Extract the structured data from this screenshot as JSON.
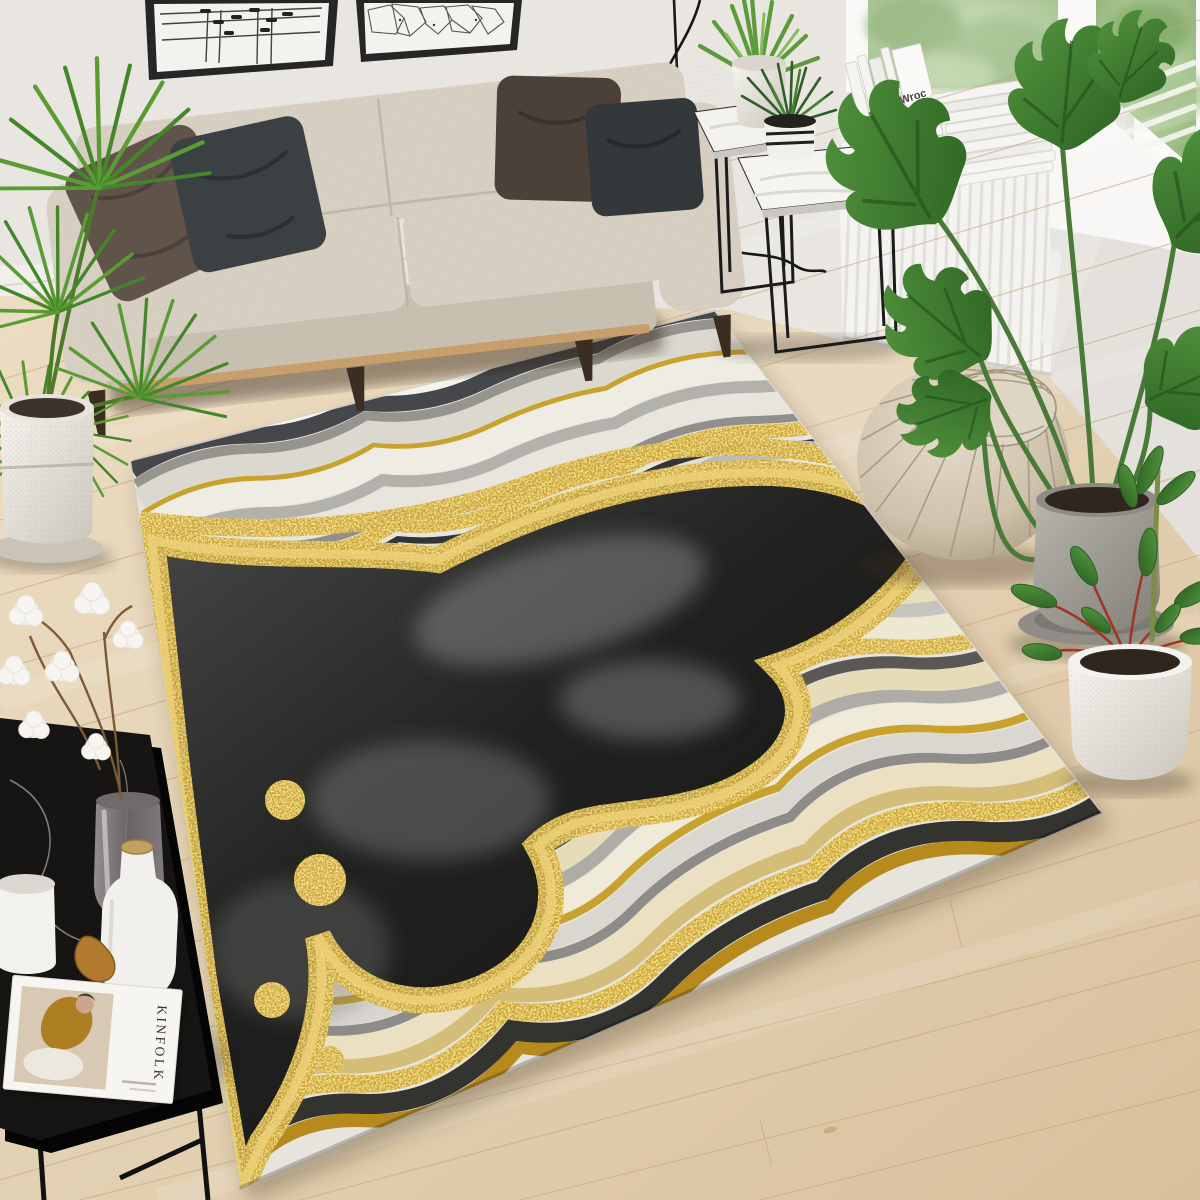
{
  "meta": {
    "scene": "living room lifestyle product photo",
    "subject": "black gold white abstract marble agate area rug",
    "view": "elevated three-quarter perspective"
  },
  "texts": {
    "magazine_title": "KINFOLK",
    "book_cover": "Wroc"
  },
  "palette": {
    "wall": "#e9e6e2",
    "wall_right": "#e4e1dc",
    "baseboard": "#f1efec",
    "floor": "#e3d1b3",
    "floor_seam": "#c3a67e",
    "sofa": "#d6cfc2",
    "sofa_front": "#c7bfb0",
    "sofa_rail": "#c89e6a",
    "leg_wood": "#3a2d22",
    "pillow_brown": "#60544a",
    "pillow_charcoal": "#3b4043",
    "pillow_espresso": "#4c4138",
    "pillow_slate": "#33383b",
    "frame_black": "#262626",
    "art_paper": "#f4f2ee",
    "palm_green": "#5a9c33",
    "palm_dark": "#44872a",
    "monstera_green": "#457f36",
    "pot_white": "#efede8",
    "pot_concrete": "#908d87",
    "soil": "#2f261e",
    "pouf_top": "#ded5c4",
    "pouf_stitch": "#a2947c",
    "radiator": "#f4f3f0",
    "sill": "#f8f7f5",
    "window_green": "#9cbb82",
    "book_white": "#f5f4f1",
    "rug_base": "#e7e4dc",
    "rug_white": "#efece5",
    "rug_gray": "#b4b2ad",
    "rug_charcoal": "#3e4042",
    "rug_black": "#1d1d1c",
    "rug_cream": "#e9dfbd",
    "gold": "#c9a22e",
    "gold_deep": "#8f6d12",
    "gold_pale": "#e6cf8f",
    "table_black": "#161514",
    "glass": "#8b8487",
    "cork": "#c2a063",
    "cotton": "#f7f5f1",
    "twig": "#7b5a38",
    "magazine_paper": "#f7f5f1",
    "magazine_photo_bg": "#d8c9b4",
    "magazine_outfit": "#ad7f22",
    "dried_leaf": "#b27a2e"
  },
  "objects": [
    "framed abstract line art",
    "framed polygonal web art",
    "beige three seat fabric sofa",
    "brown throw pillow",
    "charcoal throw pillow",
    "espresso throw pillow",
    "slate throw pillow",
    "palm plant in white pot",
    "black metal nesting side tables with marble tops",
    "aloe plant in white pot",
    "succulent in striped pot",
    "floor lamp cord",
    "white panel radiator",
    "white books stacked on windowsill",
    "window with garden view",
    "monstera plant in concrete pot",
    "moroccan leather pouf",
    "black gold marble agate area rug",
    "black marble coffee table",
    "glass vase with cotton branch",
    "white ceramic cup",
    "white bottle vase with cork lid",
    "kinfolk magazine",
    "dried leaf",
    "houseplant in white round pot",
    "light oak plank floor"
  ]
}
